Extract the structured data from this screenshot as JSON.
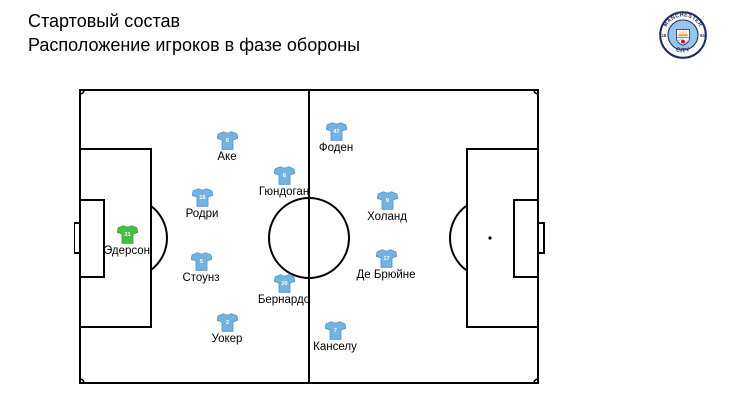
{
  "header": {
    "title_line1": "Стартовый состав",
    "title_line2": "Расположение игроков в фазе обороны"
  },
  "logo": {
    "club": "Manchester City",
    "text_top": "MANCHESTER",
    "text_bottom": "CITY",
    "year_left": "18",
    "year_right": "94",
    "colors": {
      "navy": "#1C2C5B",
      "sky": "#98C5E9",
      "gold": "#EBA63F",
      "red": "#D21034",
      "white": "#FFFFFF"
    }
  },
  "pitch": {
    "description": "football pitch, defensive-phase player placement",
    "line_color": "#000000",
    "background": "#FFFFFF"
  },
  "colors": {
    "outfield": "#74B2DF",
    "outfield_outline": "#4E93C8",
    "goalkeeper": "#44C144",
    "goalkeeper_outline": "#2FA52F",
    "number": "#FFFFFF"
  },
  "players": [
    {
      "name": "Эдерсон",
      "number": "31",
      "role": "goalkeeper",
      "x": 127,
      "y": 234
    },
    {
      "name": "Уокер",
      "number": "2",
      "role": "outfield",
      "x": 227,
      "y": 322
    },
    {
      "name": "Стоунз",
      "number": "5",
      "role": "outfield",
      "x": 201,
      "y": 261
    },
    {
      "name": "Аке",
      "number": "6",
      "role": "outfield",
      "x": 227,
      "y": 140
    },
    {
      "name": "Родри",
      "number": "16",
      "role": "outfield",
      "x": 202,
      "y": 197
    },
    {
      "name": "Гюндоган",
      "number": "8",
      "role": "outfield",
      "x": 284,
      "y": 175
    },
    {
      "name": "Бернардо",
      "number": "20",
      "role": "outfield",
      "x": 284,
      "y": 283
    },
    {
      "name": "Де Брюйне",
      "number": "17",
      "role": "outfield",
      "x": 386,
      "y": 258
    },
    {
      "name": "Фоден",
      "number": "47",
      "role": "outfield",
      "x": 336,
      "y": 131
    },
    {
      "name": "Холанд",
      "number": "9",
      "role": "outfield",
      "x": 387,
      "y": 200
    },
    {
      "name": "Канселу",
      "number": "7",
      "role": "outfield",
      "x": 335,
      "y": 330
    }
  ]
}
